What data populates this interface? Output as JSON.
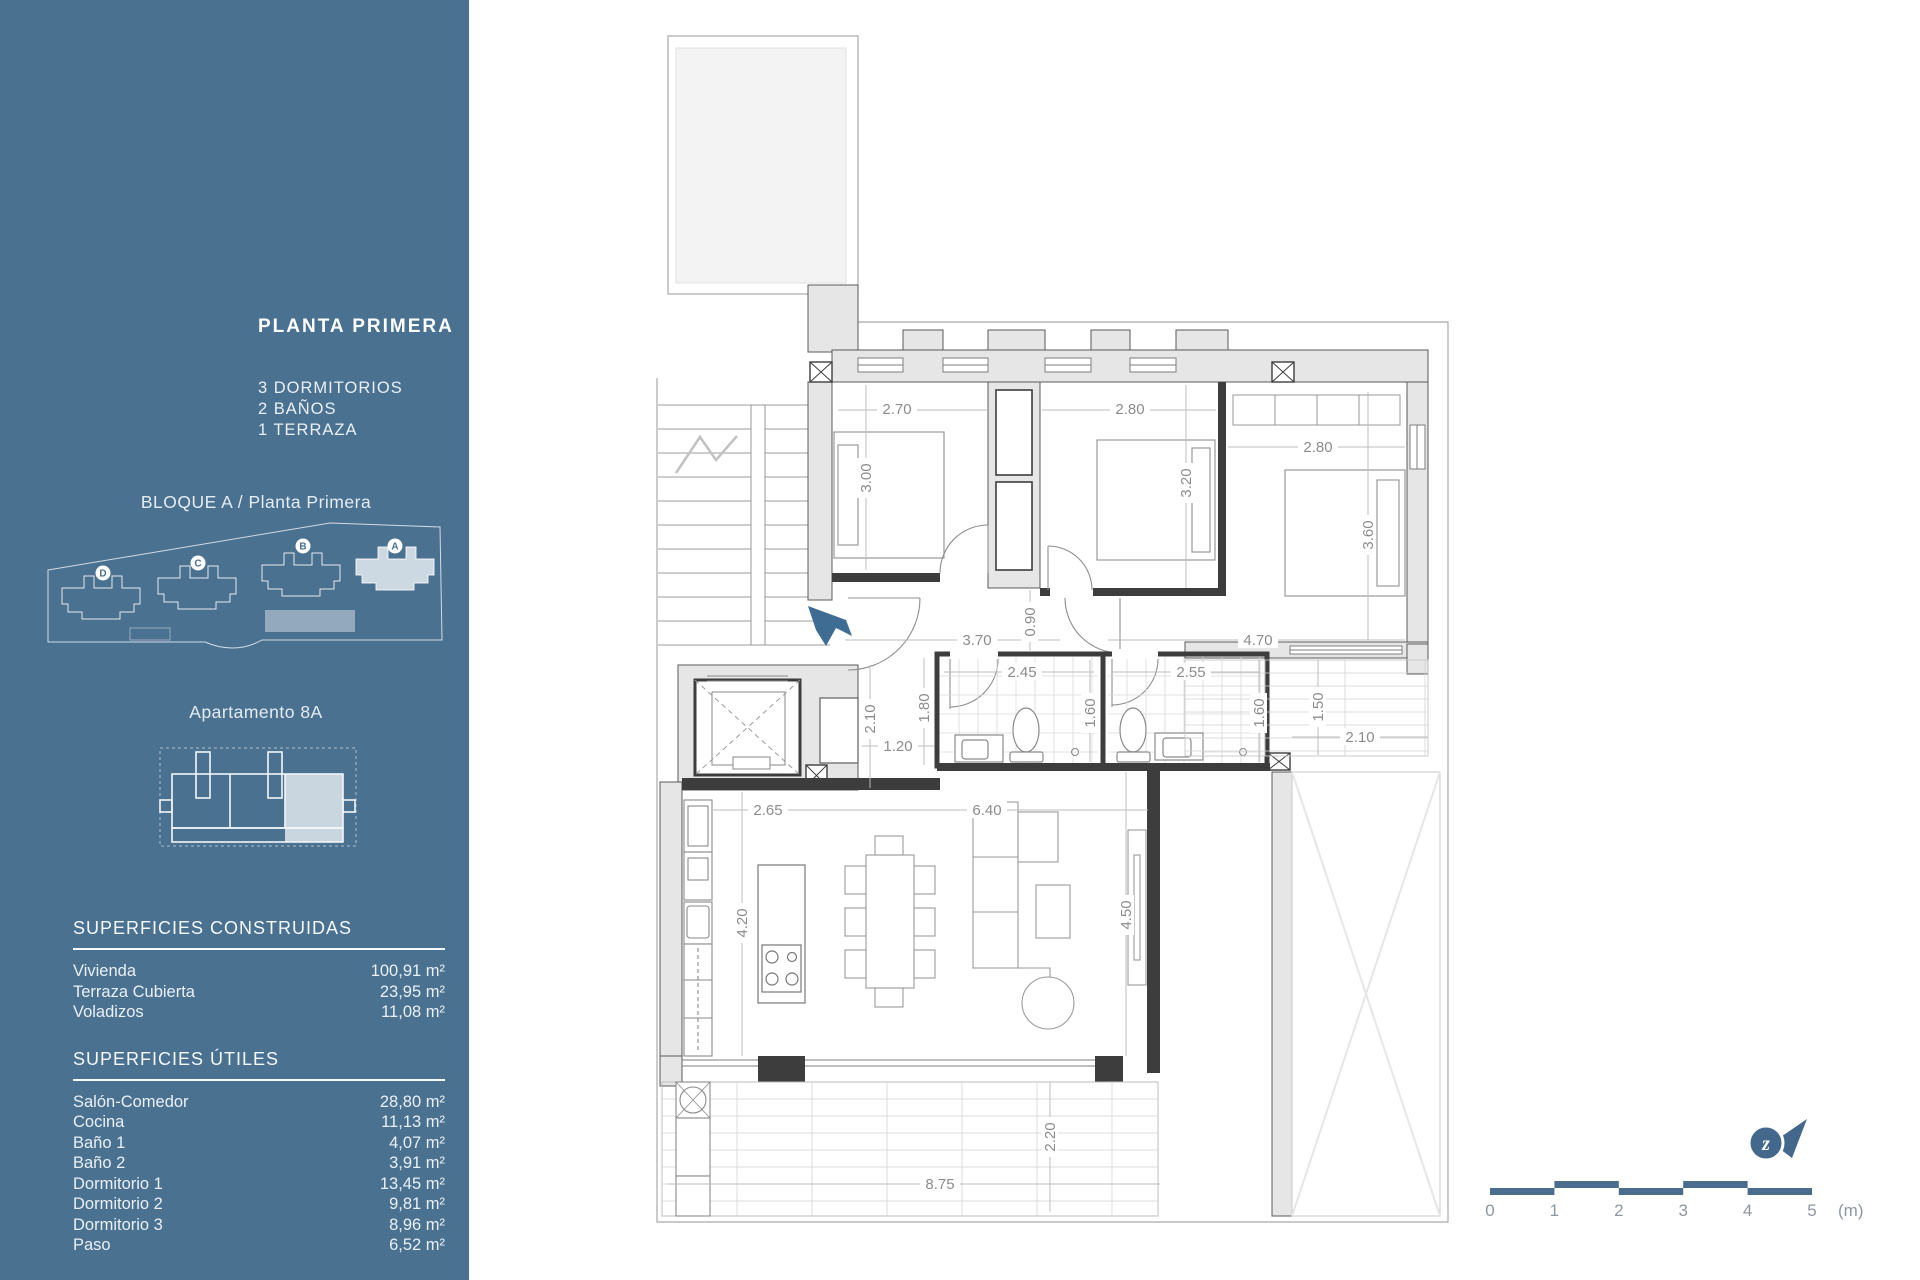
{
  "sidebar": {
    "floor_title": "PLANTA PRIMERA",
    "features": [
      "3 DORMITORIOS",
      "2 BAÑOS",
      "1 TERRAZA"
    ],
    "block_title": "BLOQUE A / Planta Primera",
    "site_blocks": [
      {
        "label": "D"
      },
      {
        "label": "C"
      },
      {
        "label": "B"
      },
      {
        "label": "A",
        "highlighted": true
      }
    ],
    "apartment_title": "Apartamento 8A",
    "surfaces_built": {
      "heading": "SUPERFICIES CONSTRUIDAS",
      "rows": [
        {
          "label": "Vivienda",
          "value": "100,91 m²"
        },
        {
          "label": "Terraza Cubierta",
          "value": "23,95 m²"
        },
        {
          "label": "Voladizos",
          "value": "11,08 m²"
        }
      ]
    },
    "surfaces_useful": {
      "heading": "SUPERFICIES ÚTILES",
      "rows": [
        {
          "label": "Salón-Comedor",
          "value": "28,80 m²"
        },
        {
          "label": "Cocina",
          "value": "11,13 m²"
        },
        {
          "label": "Baño 1",
          "value": "4,07 m²"
        },
        {
          "label": "Baño 2",
          "value": "3,91 m²"
        },
        {
          "label": "Dormitorio 1",
          "value": "13,45 m²"
        },
        {
          "label": "Dormitorio 2",
          "value": "9,81 m²"
        },
        {
          "label": "Dormitorio 3",
          "value": "8,96 m²"
        },
        {
          "label": "Paso",
          "value": "6,52 m²"
        }
      ]
    },
    "accent_color": "#4b7191",
    "highlight_color": "#c9d5df"
  },
  "floor_plan": {
    "dimensions": [
      {
        "t": "2.70",
        "x": 897,
        "y": 409,
        "r": 0
      },
      {
        "t": "2.80",
        "x": 1130,
        "y": 409,
        "r": 0
      },
      {
        "t": "3.00",
        "x": 866,
        "y": 478,
        "r": 1
      },
      {
        "t": "3.20",
        "x": 1186,
        "y": 483,
        "r": 1
      },
      {
        "t": "2.80",
        "x": 1318,
        "y": 447,
        "r": 0
      },
      {
        "t": "3.60",
        "x": 1368,
        "y": 535,
        "r": 1
      },
      {
        "t": "3.70",
        "x": 977,
        "y": 640,
        "r": 0
      },
      {
        "t": "0.90",
        "x": 1030,
        "y": 622,
        "r": 1
      },
      {
        "t": "4.70",
        "x": 1258,
        "y": 640,
        "r": 0
      },
      {
        "t": "2.45",
        "x": 1022,
        "y": 672,
        "r": 0
      },
      {
        "t": "2.55",
        "x": 1191,
        "y": 672,
        "r": 0
      },
      {
        "t": "1.80",
        "x": 924,
        "y": 708,
        "r": 1
      },
      {
        "t": "1.60",
        "x": 1090,
        "y": 713,
        "r": 1
      },
      {
        "t": "1.60",
        "x": 1259,
        "y": 713,
        "r": 1
      },
      {
        "t": "2.10",
        "x": 870,
        "y": 719,
        "r": 1
      },
      {
        "t": "1.20",
        "x": 898,
        "y": 746,
        "r": 0
      },
      {
        "t": "1.50",
        "x": 1318,
        "y": 707,
        "r": 1
      },
      {
        "t": "2.10",
        "x": 1360,
        "y": 737,
        "r": 0
      },
      {
        "t": "2.65",
        "x": 768,
        "y": 810,
        "r": 0
      },
      {
        "t": "6.40",
        "x": 987,
        "y": 810,
        "r": 0
      },
      {
        "t": "4.20",
        "x": 742,
        "y": 923,
        "r": 1
      },
      {
        "t": "4.50",
        "x": 1126,
        "y": 915,
        "r": 1
      },
      {
        "t": "2.20",
        "x": 1050,
        "y": 1137,
        "r": 1
      },
      {
        "t": "8.75",
        "x": 940,
        "y": 1184,
        "r": 0
      }
    ]
  },
  "scale_bar": {
    "labels": [
      "0",
      "1",
      "2",
      "3",
      "4",
      "5"
    ],
    "unit": "(m)",
    "bar_color": "#4a6c8d"
  },
  "compass": {
    "letter": "z"
  }
}
